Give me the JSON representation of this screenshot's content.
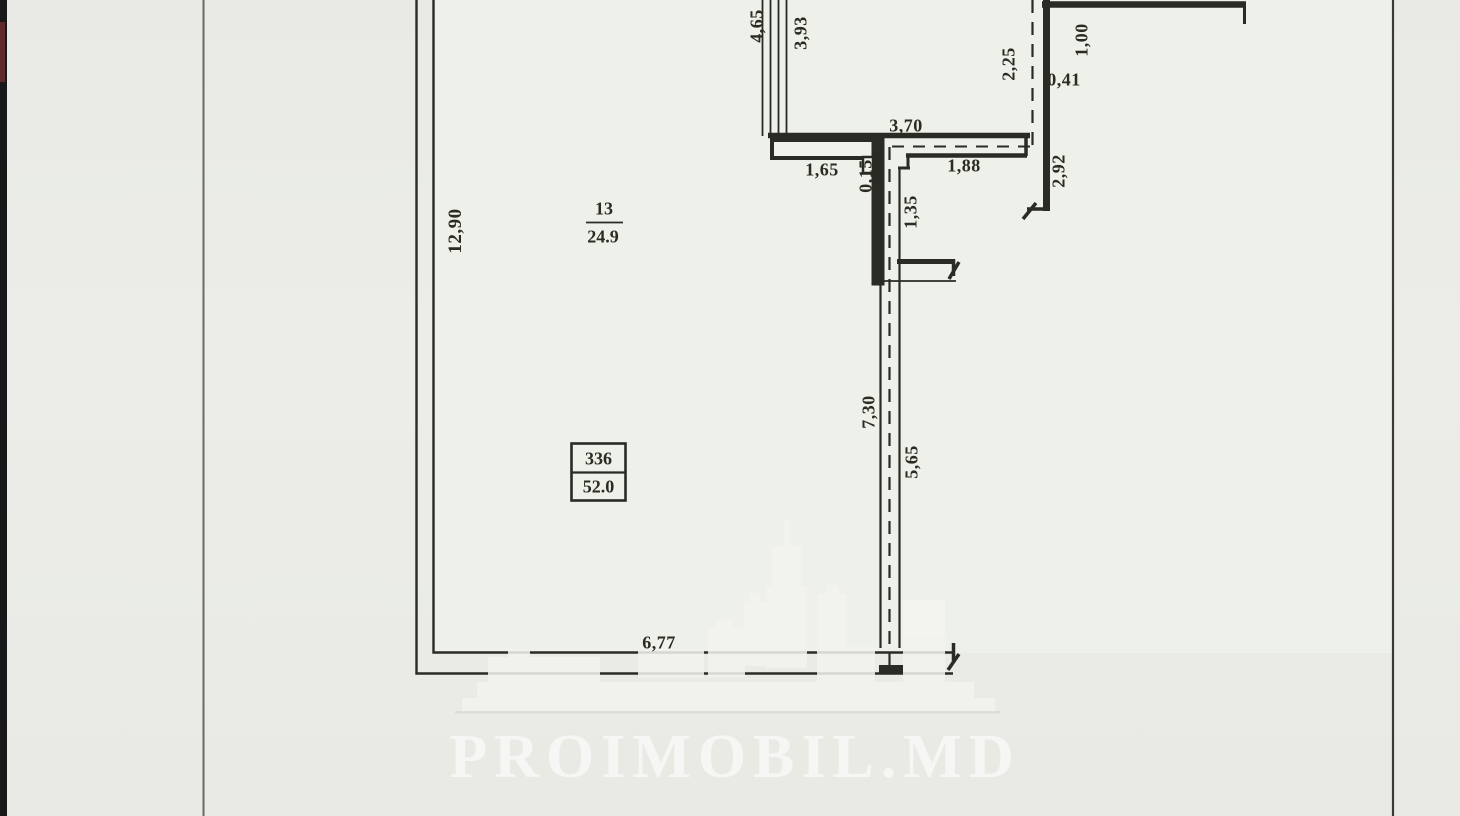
{
  "watermark": {
    "brand": "PROIMOBIL.MD"
  },
  "room": {
    "number": "13",
    "area": "24.9"
  },
  "unit_box": {
    "id": "336",
    "area": "52.0"
  },
  "dimensions": {
    "balcony_outer": "4,65",
    "balcony_inner": "3,93",
    "top_wall": "3,70",
    "entry_left": "1,65",
    "wall_step": "0,15",
    "entry_right": "1,88",
    "stub_height": "1,35",
    "dashed_top": "2,25",
    "top_right_width": "1,00",
    "top_right_offset": "0,41",
    "right_wall_height": "2,92",
    "left_wall_height": "12,90",
    "partition_upper": "7,30",
    "partition_lower": "5,65",
    "bottom_width": "6,77"
  }
}
